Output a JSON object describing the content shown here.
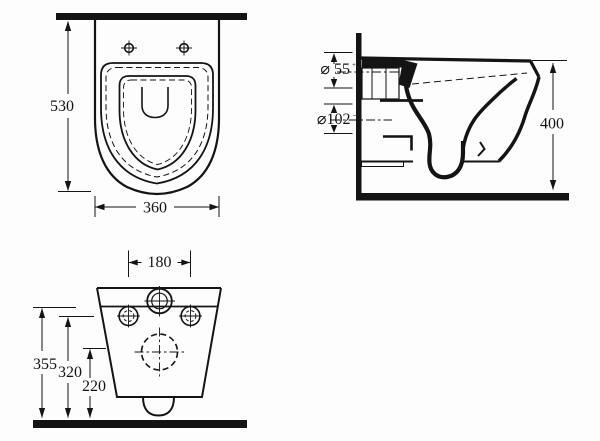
{
  "page": {
    "background": "#fdfdfd",
    "line_color": "#141414"
  },
  "views": {
    "plan": {
      "dims": {
        "depth": "530",
        "width": "360"
      }
    },
    "side": {
      "dims": {
        "inlet_dia": "⌀ 55",
        "inlet_tol": "+0/-1",
        "outlet_dia": "⌀102",
        "outlet_tol": "-4",
        "height": "400"
      }
    },
    "rear": {
      "dims": {
        "bolt_spacing": "180",
        "height_total": "355",
        "height_bolts": "320",
        "height_outlet": "220"
      }
    }
  }
}
